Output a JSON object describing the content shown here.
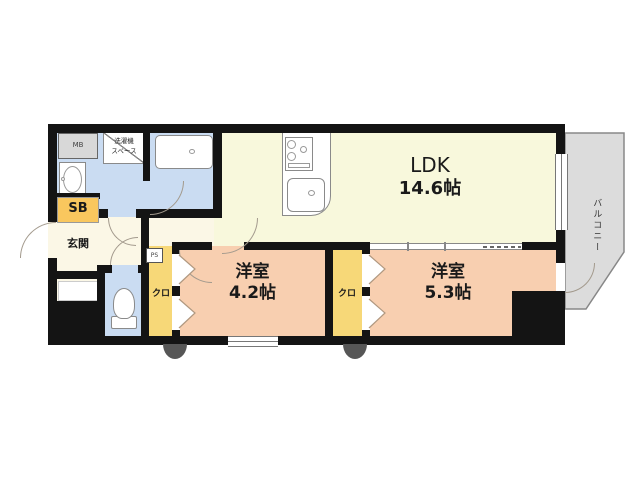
{
  "floorplan": {
    "ldk": {
      "name": "LDK",
      "size": "14.6帖"
    },
    "bedroom1": {
      "name": "洋室",
      "size": "4.2帖"
    },
    "bedroom2": {
      "name": "洋室",
      "size": "5.3帖"
    },
    "entrance": {
      "label": "玄関"
    },
    "closet1": {
      "label": "クロ"
    },
    "closet2": {
      "label": "クロ"
    },
    "balcony": {
      "label": "バルコニー"
    },
    "shoe_box": {
      "label": "SB"
    },
    "meter_box": {
      "label": "MB"
    },
    "pipe_space": {
      "label": "PS"
    },
    "washer_space": {
      "line1": "洗濯機",
      "line2": "スペース"
    },
    "colors": {
      "wall": "#141414",
      "ldk_floor": "#f8f8dc",
      "hall_floor": "#fbf7e6",
      "bedroom_floor": "#f8cfb0",
      "closet_floor": "#f7d878",
      "shoe_box_fill": "#f9c75e",
      "sanitary_floor": "#cadcf2",
      "balcony_fill": "#dcdcdc",
      "meter_box_fill": "#d8d8d8"
    }
  }
}
